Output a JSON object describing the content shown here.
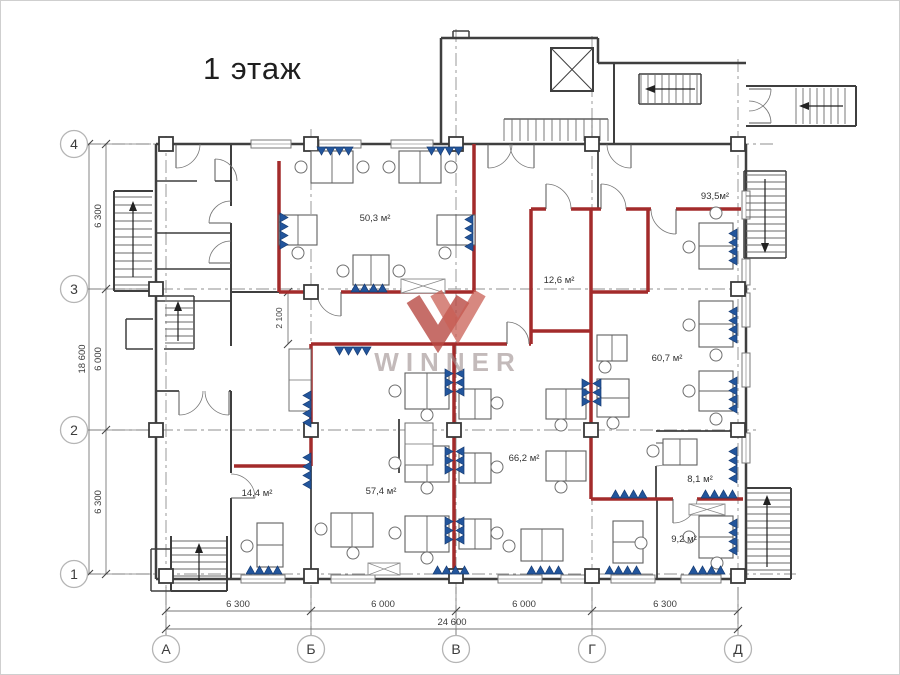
{
  "title": "1 этаж",
  "watermark": "WINNER",
  "axes": {
    "columns": [
      {
        "label": "А",
        "x": 165
      },
      {
        "label": "Б",
        "x": 310
      },
      {
        "label": "В",
        "x": 455
      },
      {
        "label": "Г",
        "x": 591
      },
      {
        "label": "Д",
        "x": 737
      }
    ],
    "rows": [
      {
        "label": "4",
        "y": 143
      },
      {
        "label": "3",
        "y": 288
      },
      {
        "label": "2",
        "y": 429
      },
      {
        "label": "1",
        "y": 573
      }
    ]
  },
  "dimensions": {
    "bottom_segments": [
      {
        "text": "6 300",
        "x": 237
      },
      {
        "text": "6 000",
        "x": 382
      },
      {
        "text": "6 000",
        "x": 523
      },
      {
        "text": "6 300",
        "x": 664
      }
    ],
    "bottom_total": "24 600",
    "left_segments": [
      {
        "text": "6 300",
        "y": 215
      },
      {
        "text": "6 000",
        "y": 358
      },
      {
        "text": "6 300",
        "y": 501
      }
    ],
    "left_total": "18 600",
    "interior": "2 100"
  },
  "rooms": [
    {
      "area": "50,3 м²",
      "x": 374,
      "y": 220
    },
    {
      "area": "93,5м²",
      "x": 714,
      "y": 198
    },
    {
      "area": "12,6 м²",
      "x": 558,
      "y": 282
    },
    {
      "area": "60,7 м²",
      "x": 666,
      "y": 360
    },
    {
      "area": "66,2 м²",
      "x": 523,
      "y": 460
    },
    {
      "area": "57,4 м²",
      "x": 380,
      "y": 493
    },
    {
      "area": "14,4 м²",
      "x": 256,
      "y": 495
    },
    {
      "area": "8,1 м²",
      "x": 699,
      "y": 481
    },
    {
      "area": "9,2 м²",
      "x": 683,
      "y": 541
    }
  ],
  "colors": {
    "wall": "#3f3f3f",
    "light_wall": "#6a6a6a",
    "highlight_red": "#a32b2b",
    "radiator_blue": "#22559c",
    "radiator_edge": "#173c73",
    "axis_line": "#8f8f8f",
    "dim_line": "#777777",
    "dim_text": "#3c3c3c",
    "label_text": "#333333",
    "furniture": "#5f5f5f",
    "watermark_red": "#b84a44",
    "watermark_red2": "#c96055",
    "watermark_text": "#9c8d8d"
  }
}
